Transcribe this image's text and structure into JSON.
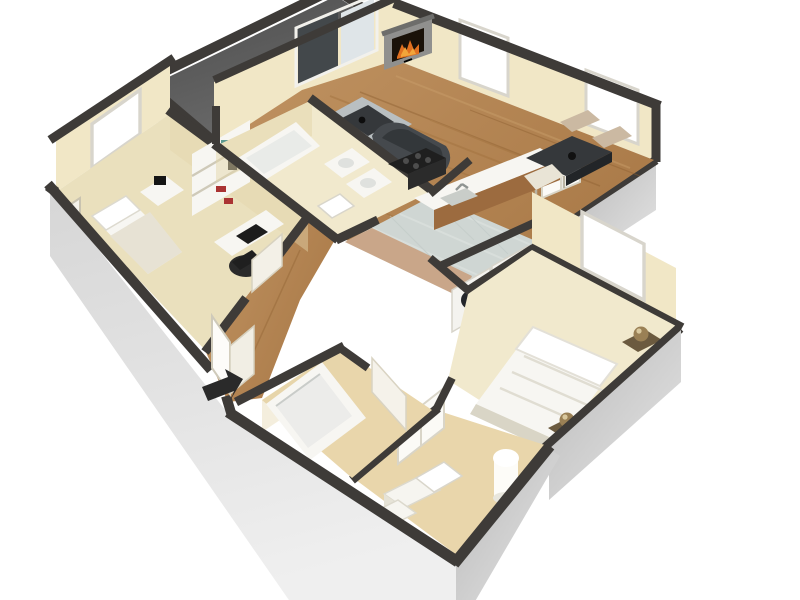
{
  "meta": {
    "title": "3D Floor Plan Rendering",
    "type": "isometric-3d-floorplan-render",
    "background": "#ffffff"
  },
  "colors": {
    "background": "#ffffff",
    "wallCap": "#3e3b38",
    "outerWall": "#c6c6c6",
    "outerWallLight": "#e9e9e9",
    "innerWall": "#f1e7c6",
    "innerWallShade": "#e4d5aa",
    "innerWallDark": "#d4c294",
    "carpet": "#eae0bd",
    "carpetLight": "#f1e9cd",
    "wood": "#b6895b",
    "woodStreak": "#a1713d",
    "patioFloor": "#646464",
    "patioFloorDark": "#4e4e4e",
    "kitchenTile": "#cfd6d3",
    "terracotta": "#c5804c",
    "bathTile": "#e9d6ab",
    "fixtureWhite": "#f7f6f2",
    "glass": "#dfe5e8",
    "glassDark": "#43484b",
    "sofa": "#45494d",
    "rug": "#b9bfc1",
    "tableDark": "#35383b",
    "fire": "#e07020",
    "fireGlow": "#f2a53a",
    "brass": "#9a8055",
    "appliance": "#1f1f1f",
    "cabinetWood": "#9c6b3f",
    "windowFrame": "#d8d5cc",
    "arrow": "#2a2a2a"
  },
  "rooms": [
    {
      "id": "patio",
      "label": "Patio"
    },
    {
      "id": "living-room",
      "label": "Living Room"
    },
    {
      "id": "dining-area",
      "label": "Dining Area"
    },
    {
      "id": "kitchen",
      "label": "Kitchen"
    },
    {
      "id": "bedroom-2",
      "label": "Bedroom 2"
    },
    {
      "id": "bathroom-1",
      "label": "Bathroom 1"
    },
    {
      "id": "hallway",
      "label": "Hallway"
    },
    {
      "id": "laundry-closet",
      "label": "Laundry Closet"
    },
    {
      "id": "master-bedroom",
      "label": "Master Bedroom"
    },
    {
      "id": "dressing-area",
      "label": "Dressing Area"
    },
    {
      "id": "bathroom-2",
      "label": "Bathroom 2"
    },
    {
      "id": "entry",
      "label": "Entry"
    }
  ],
  "objects": [
    "sliding-glass-door",
    "corner-fireplace",
    "area-rug",
    "coffee-table",
    "lounge-chair",
    "dining-table",
    "dining-chairs",
    "breakfast-bar-sink",
    "range-stove",
    "pantry-doors",
    "washer-dryer",
    "bookshelf-hutch",
    "desk",
    "office-chair",
    "twin-bed",
    "nightstand",
    "double-bed",
    "bedside-lamps",
    "bathtub",
    "vanity-sinks",
    "toilet",
    "floor-lamp",
    "storage-cubes",
    "entry-door",
    "entry-arrow",
    "windows"
  ]
}
